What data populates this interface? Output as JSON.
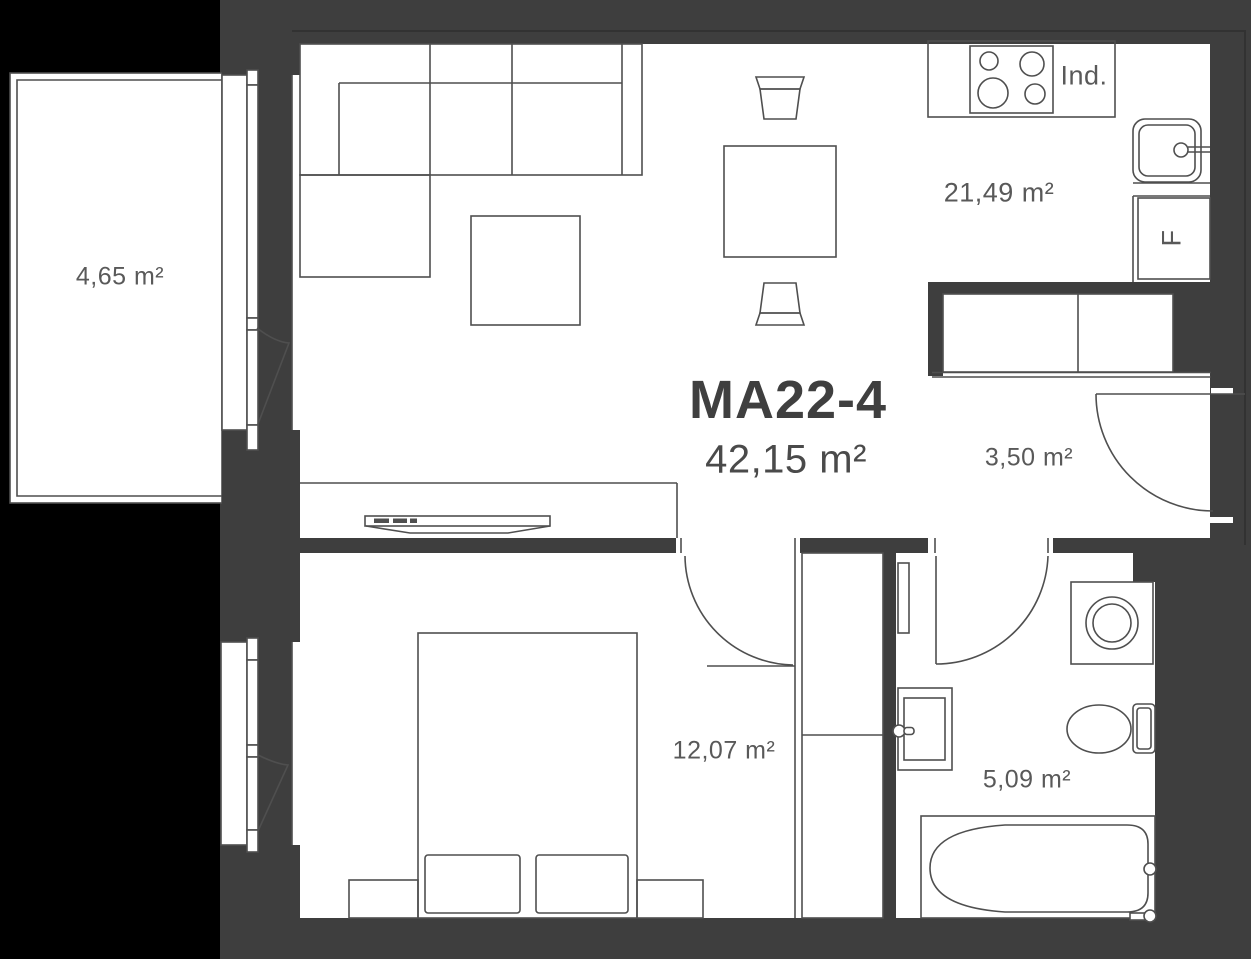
{
  "plan": {
    "unit_id": "MA22-4",
    "total_area": "42,15 m²",
    "rooms": [
      {
        "name": "balcony",
        "area": "4,65 m²"
      },
      {
        "name": "living-kitchen",
        "area": "21,49 m²"
      },
      {
        "name": "hallway",
        "area": "3,50 m²"
      },
      {
        "name": "bedroom",
        "area": "12,07 m²"
      },
      {
        "name": "bathroom",
        "area": "5,09 m²"
      }
    ],
    "labels": {
      "induction_hob": "Ind.",
      "fridge": "F"
    },
    "icons": [
      "stove-icon",
      "kitchen-sink-icon",
      "washing-machine-icon",
      "toilet-icon",
      "bathtub-icon",
      "bathroom-sink-icon"
    ],
    "colors": {
      "background": "#000000",
      "wall": "#3e3e3e",
      "floor": "#ffffff",
      "line": "#4f4f4f",
      "text": "#595959",
      "title": "#3f3f3f"
    }
  }
}
